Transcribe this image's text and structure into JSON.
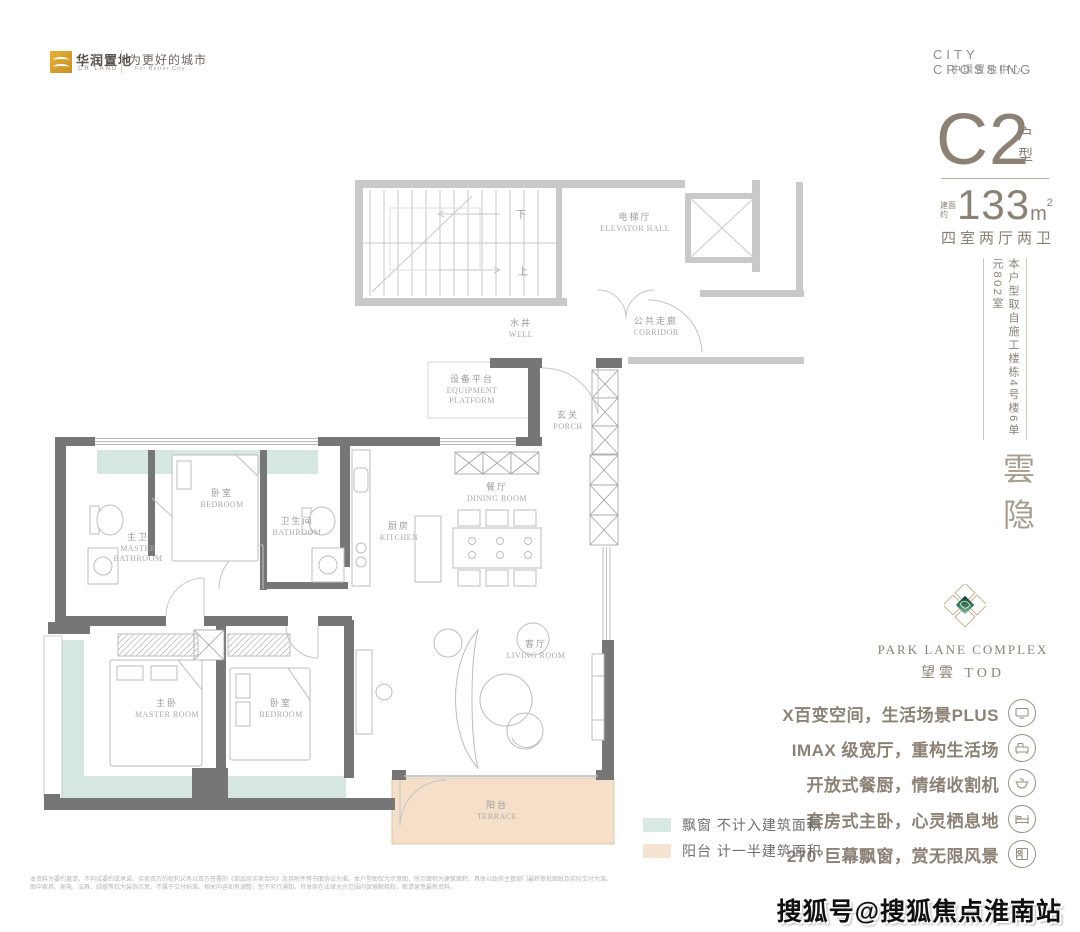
{
  "header": {
    "left": {
      "brand": "华润置地",
      "brand_en": "CR LAND",
      "slogan": "为更好的城市",
      "slogan_en": "For Better City"
    },
    "right": {
      "line1": "CITY CROSSING",
      "line2": "中環置地中心"
    }
  },
  "unit_panel": {
    "code": "C2",
    "code_label": "户型",
    "area_prefix": "建面约",
    "area_number": "133",
    "area_unit": "m",
    "area_sup": "2",
    "rooms_spec": "四室两厅两卫",
    "source_note": "本户型取自施工楼栋4号楼6单元802室",
    "project_name": "雲隐",
    "brand_en": "PARK LANE COMPLEX",
    "brand_cn": "望雲 TOD",
    "selling_points": [
      {
        "text": "X百变空间，生活场景PLUS",
        "icon": "monitor-icon"
      },
      {
        "text": "IMAX 级宽厅，重构生活场",
        "icon": "sofa-icon"
      },
      {
        "text": "开放式餐厨，情绪收割机",
        "icon": "pot-icon"
      },
      {
        "text": "套房式主卧，心灵栖息地",
        "icon": "bed-icon"
      },
      {
        "text": "270°巨幕飘窗，赏无限风景",
        "icon": "window-view-icon"
      }
    ]
  },
  "legend": {
    "items": [
      {
        "label": "飘窗 不计入建筑面积",
        "color": "#d9e8e4"
      },
      {
        "label": "阳台 计一半建筑面积",
        "color": "#f7e3d2"
      }
    ]
  },
  "floorplan": {
    "rooms": {
      "elevator_hall": {
        "cn": "电梯厅",
        "en": "ELEVATOR HALL"
      },
      "corridor": {
        "cn": "公共走廊",
        "en": "CORRIDOR"
      },
      "well": {
        "cn": "水井",
        "en": "WELL"
      },
      "equipment_platform": {
        "cn": "设备平台",
        "en": "EQUIPMENT PLATFORM"
      },
      "porch": {
        "cn": "玄关",
        "en": "PORCH"
      },
      "dining_room": {
        "cn": "餐厅",
        "en": "DINING ROOM"
      },
      "kitchen": {
        "cn": "厨房",
        "en": "KITCHEN"
      },
      "bedroom_top": {
        "cn": "卧室",
        "en": "BEDROOM"
      },
      "bathroom": {
        "cn": "卫生间",
        "en": "BATHROOM"
      },
      "master_bathroom": {
        "cn": "主卫",
        "en": "MASTER BATHROOM"
      },
      "master_room": {
        "cn": "主卧",
        "en": "MASTER ROOM"
      },
      "bedroom_second": {
        "cn": "卧室",
        "en": "BEDROOM"
      },
      "living_room": {
        "cn": "客厅",
        "en": "LIVING ROOM"
      },
      "terrace": {
        "cn": "阳台",
        "en": "TERRACE"
      }
    },
    "stairs": {
      "down": "下",
      "up": "上"
    },
    "colors": {
      "unit_wall": "#767676",
      "public_wall": "#c9c9c9",
      "bay_window": "#d6e6e1",
      "terrace": "#f5dfc9"
    }
  },
  "footer": {
    "disclaimer_line1": "本资料为要约邀请，不构成要约或承诺，买卖双方的权利义务以双方签署的《商品房买卖合同》及其附件等书面协议为准。本户型图仅为示意图，所示面积为建筑面积，具体以政府主管部门最终审批图纸及实际交付为准。",
    "disclaimer_line2": "图中家具、家电、洁具、绿植等仅为装饰示意，不属于交付标准。相关内容如有调整，恕不另行通知，开发商在法律允许范围内保留解释权，敬请留意最新资料。",
    "watermark": "搜狐号@搜狐焦点淮南站"
  }
}
